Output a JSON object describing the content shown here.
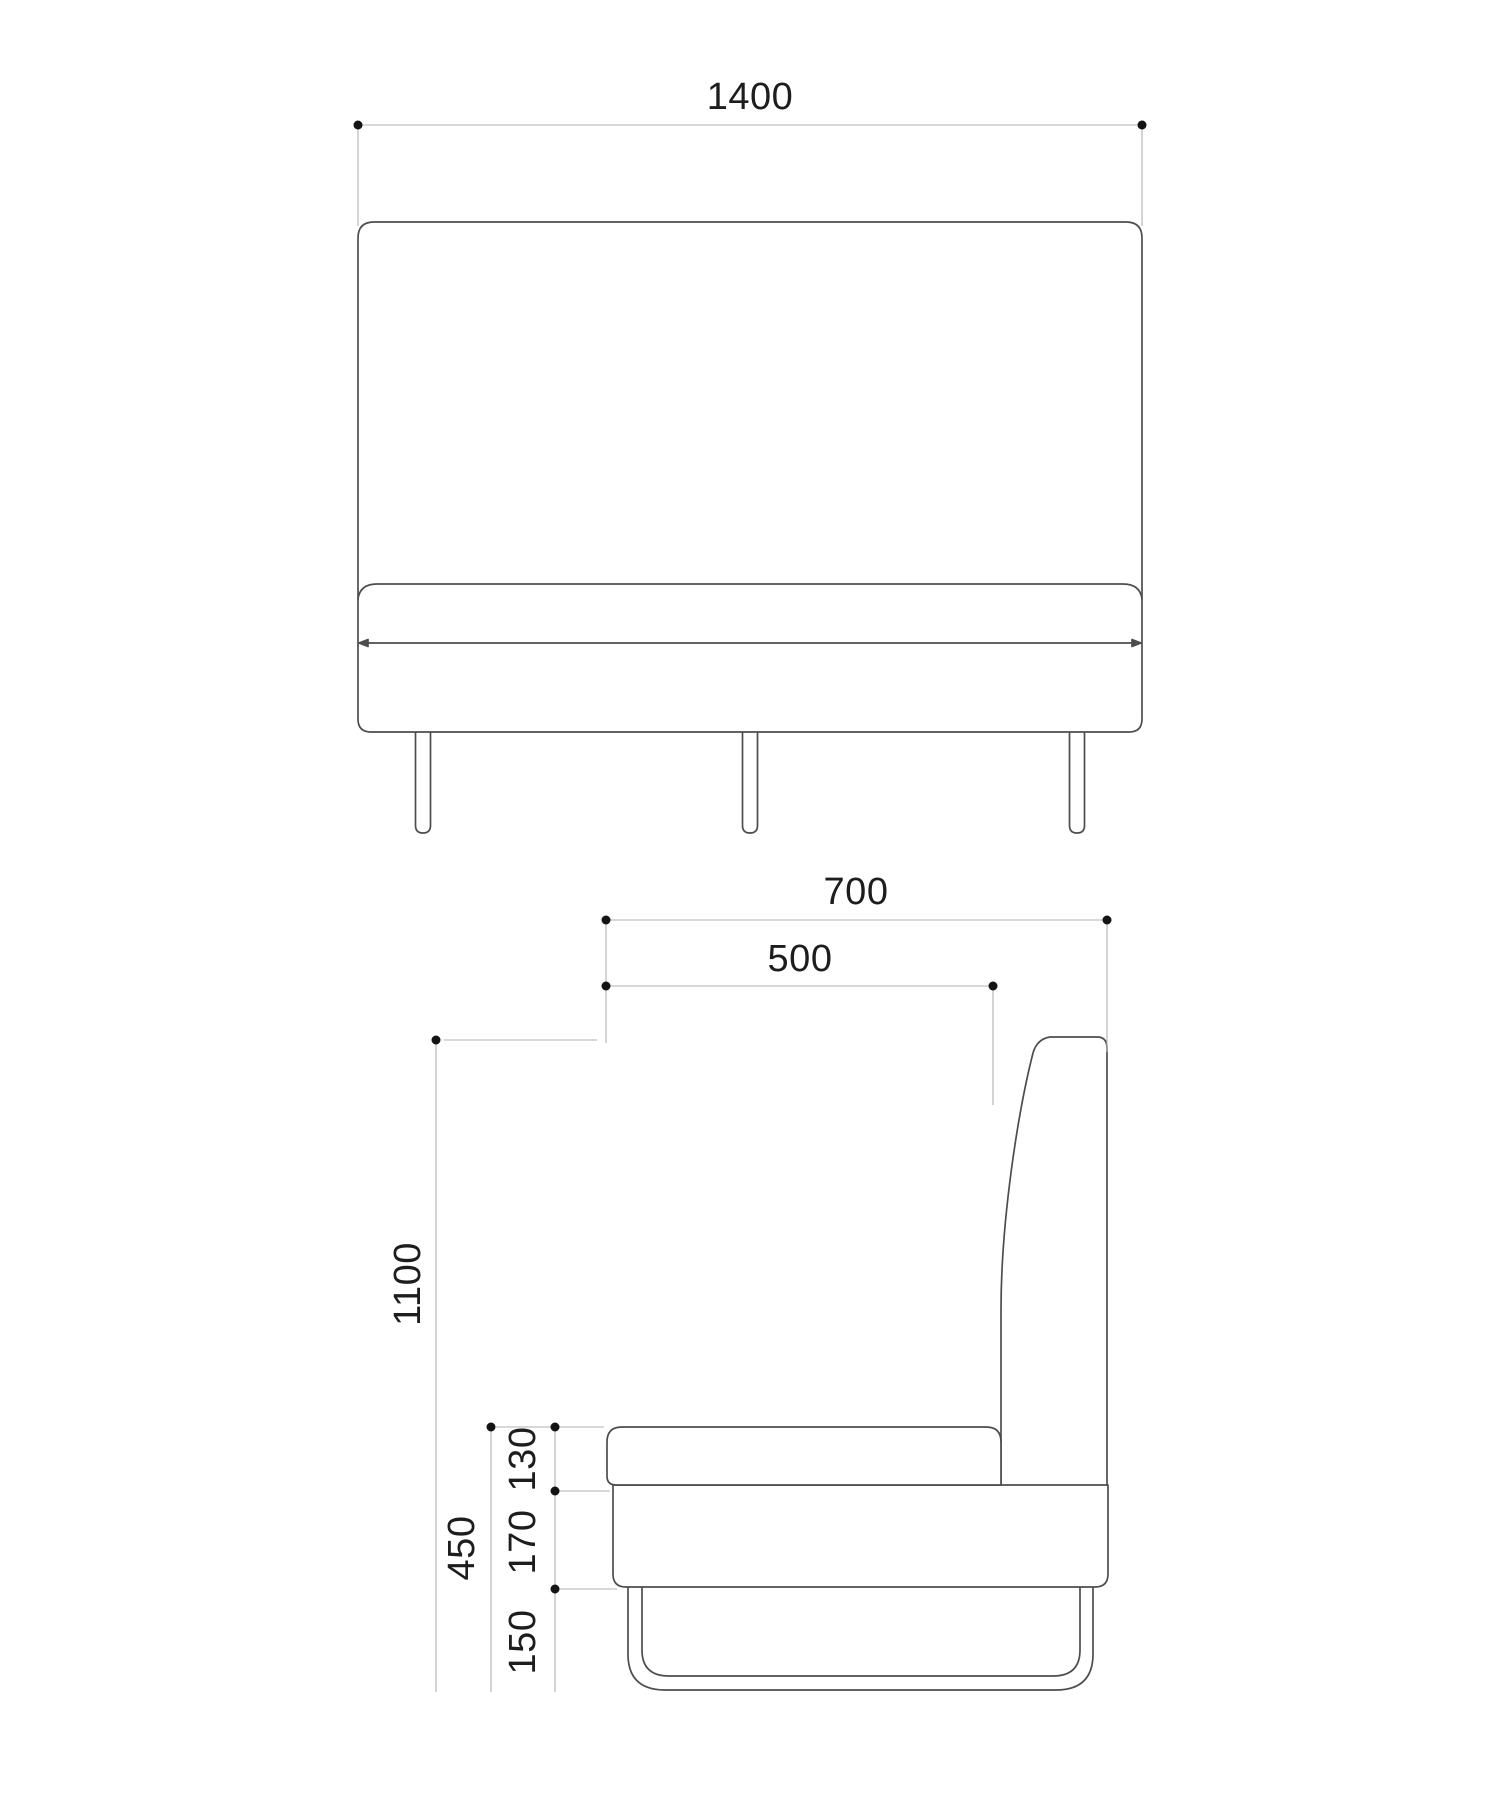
{
  "drawing_title": "upholstered bench two-view dimension drawing",
  "front_view": {
    "width_label": "1400"
  },
  "side_view": {
    "total_depth_label": "700",
    "seat_depth_label": "500",
    "total_height_label": "1100",
    "seat_height_label": "450",
    "cushion_thickness_label": "130",
    "base_height_label": "170",
    "leg_height_label": "150"
  },
  "colors": {
    "outline": "#4d4d4f",
    "dimension_line": "#b0b0b3",
    "marker": "#141414",
    "text": "#1d1d1f",
    "background": "#ffffff"
  }
}
